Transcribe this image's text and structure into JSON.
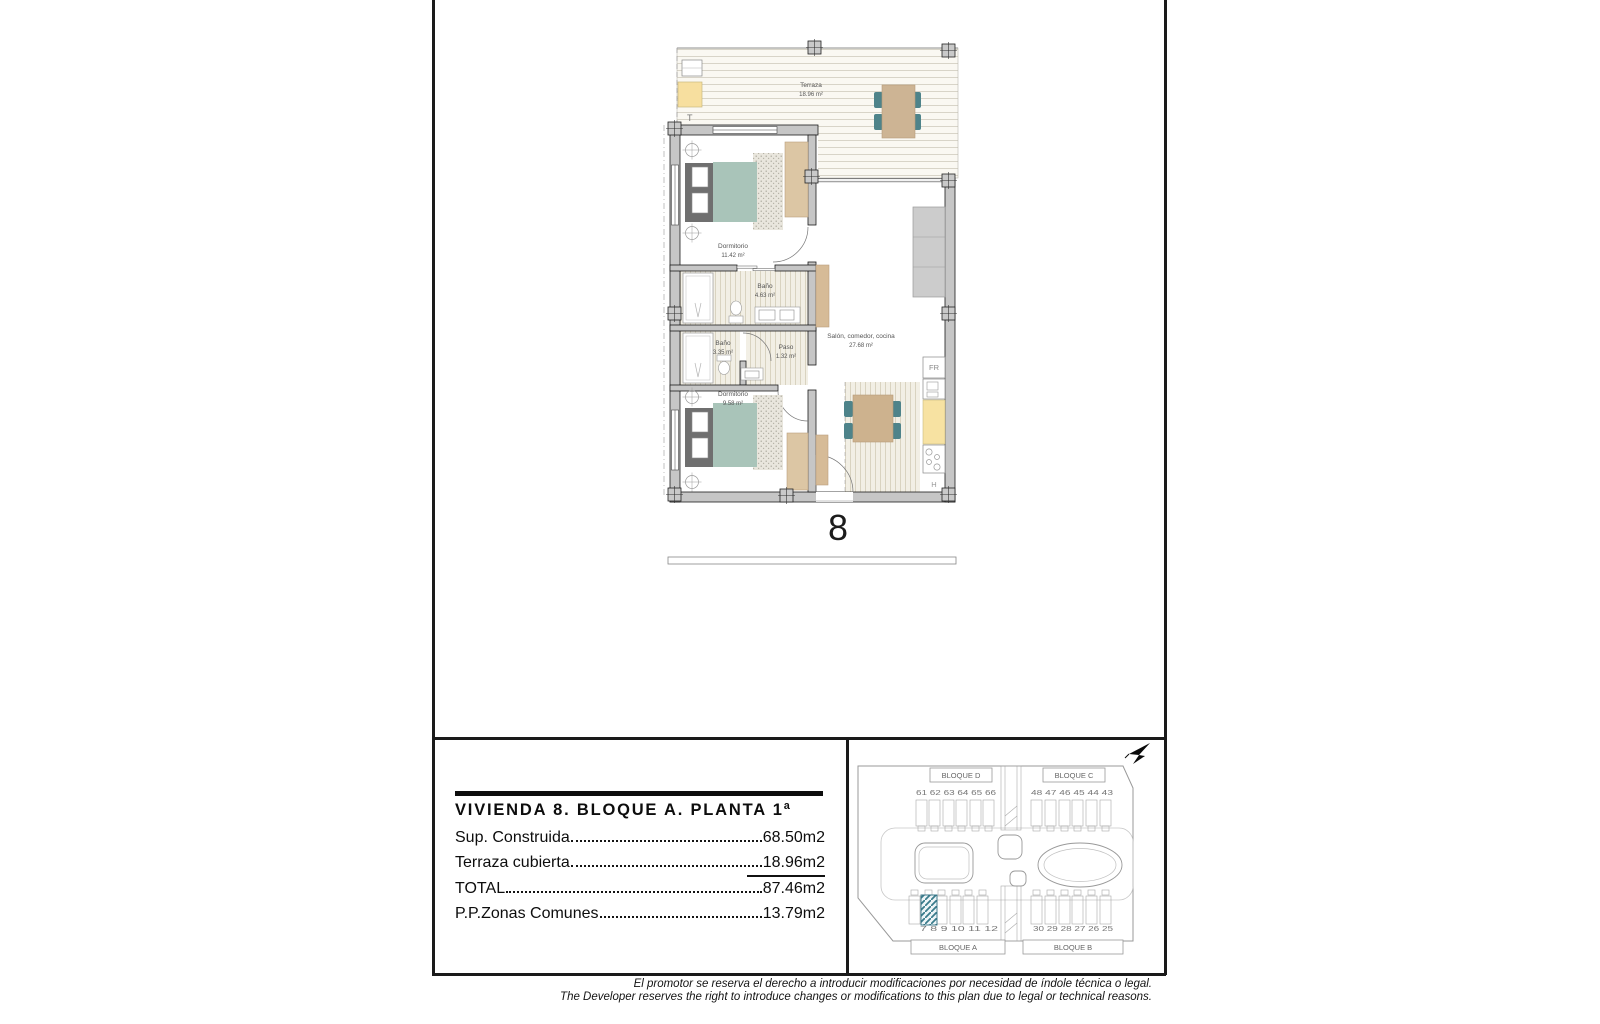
{
  "floorplan": {
    "unit_number": "8",
    "terrace_store_label": "T",
    "rooms": {
      "terraza": {
        "name": "Terraza",
        "area": "18.96 m²"
      },
      "dormitorio1": {
        "name": "Dormitorio",
        "area": "11.42 m²"
      },
      "bano1": {
        "name": "Baño",
        "area": "4.63 m²"
      },
      "bano2": {
        "name": "Baño",
        "area": "3.35 m²"
      },
      "paso": {
        "name": "Paso",
        "area": "1.32 m²"
      },
      "salon": {
        "name": "Salón, comedor, cocina",
        "area": "27.68 m²"
      },
      "dormitorio2": {
        "name": "Dormitorio",
        "area": "9.58 m²"
      }
    },
    "appliances": {
      "fridge": "FR",
      "hob": "H"
    }
  },
  "info_panel": {
    "title": "VIVIENDA 8. BLOQUE A. PLANTA 1ª",
    "rows": [
      {
        "label": "Sup. Construida",
        "value": "68.50m2"
      },
      {
        "label": "Terraza cubierta",
        "value": "18.96m2"
      },
      {
        "label": "TOTAL",
        "value": "87.46m2"
      },
      {
        "label": "P.P.Zonas Comunes",
        "value": "13.79m2"
      }
    ]
  },
  "site_plan": {
    "blocks": {
      "d": "BLOQUE D",
      "c": "BLOQUE C",
      "a": "BLOQUE A",
      "b": "BLOQUE B"
    },
    "units": {
      "bloque_d": "61 62 63 64 65 66",
      "bloque_c": "48 47 46 45 44 43",
      "bloque_a": "7 8 9 10 11 12",
      "bloque_b": "30 29 28 27 26 25"
    },
    "highlighted_unit": "8"
  },
  "disclaimer": {
    "es": "El promotor se reserva el derecho a introducir modificaciones por necesidad de índole técnica o legal.",
    "en": "The Developer reserves the right to introduce changes or modifications to this plan due to legal or technical reasons."
  },
  "colors": {
    "wall_gray": "#c6c6c6",
    "furniture_tan": "#d6bb97",
    "bed_sage": "#a9c4b9",
    "chair_teal": "#4e838a",
    "counter_yellow": "#f7e2a2",
    "highlight_hatch_teal": "#3a7c8c"
  }
}
